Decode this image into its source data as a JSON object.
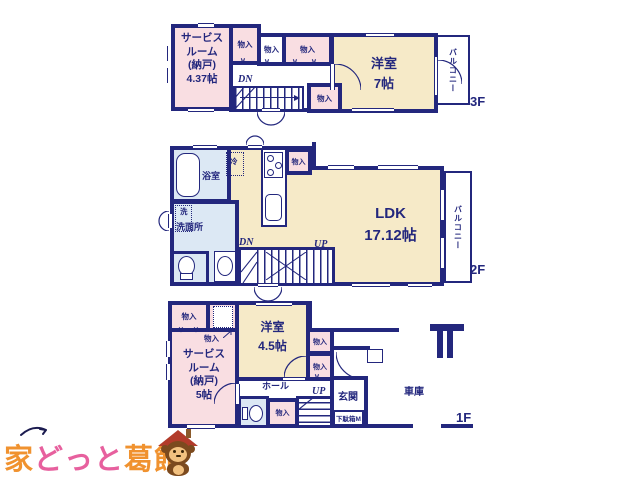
{
  "floor_plan": {
    "f3": {
      "floor_label": "3F",
      "service_room": "サービス\nルーム\n(納戸)\n4.37帖",
      "bedroom": "洋室\n7帖",
      "balcony": "バルコニー",
      "closets": [
        "物入",
        "物入",
        "物入",
        "物入"
      ],
      "down": "DN"
    },
    "f2": {
      "floor_label": "2F",
      "bath": "浴室",
      "fridge": "冷",
      "closet": "物入",
      "washer": "洗",
      "washroom": "洗面所",
      "ldk": "LDK\n17.12帖",
      "down": "DN",
      "up": "UP",
      "balcony": "バルコニー"
    },
    "f1": {
      "floor_label": "1F",
      "closets": [
        "物入",
        "物入",
        "物入",
        "物入",
        "物入"
      ],
      "underfloor": "床下収納",
      "bedroom": "洋室\n4.5帖",
      "service_room": "サービス\nルーム\n(納戸)\n5帖",
      "hall": "ホール",
      "up": "UP",
      "entrance": "玄関",
      "shoe_cabinet": "下駄箱M",
      "garage": "車庫"
    }
  },
  "logo": {
    "part1": "家",
    "part2": "どっと",
    "part3": "葛飾"
  },
  "colors": {
    "wall_navy": "#23277d",
    "room_cream": "#f6eac8",
    "room_pink": "#f9dee2",
    "room_blue": "#dce8f4",
    "logo_orange": "#f0922f",
    "logo_pink": "#e7609e"
  }
}
